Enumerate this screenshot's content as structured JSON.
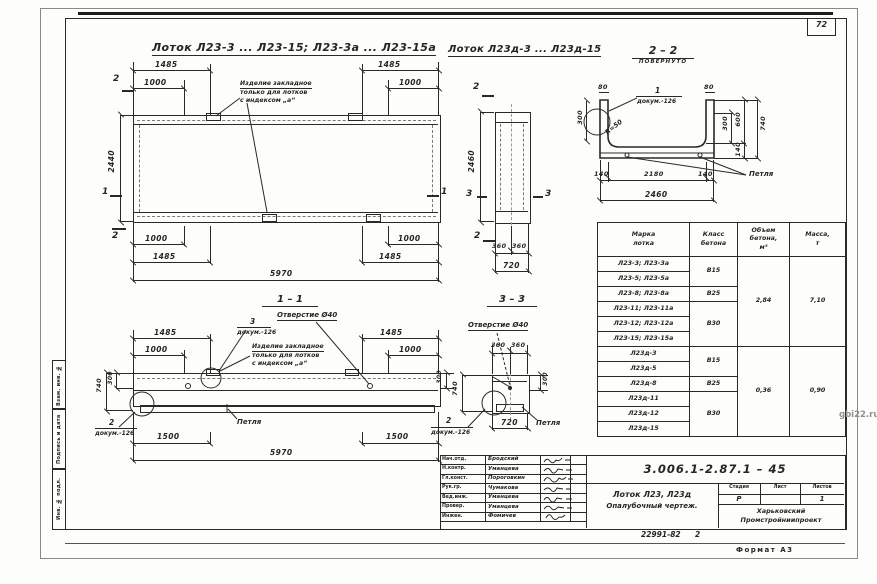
{
  "page": {
    "sheet_number": "72",
    "watermark": "gbi22.ru",
    "format_note": "Формат А3",
    "order_number": "22991-82",
    "order_extra": "2"
  },
  "margin_fields": {
    "f1": "Взам. инв. №",
    "f2": "Подпись и дата",
    "f3": "Инв. № подл."
  },
  "titles": {
    "view1": "Лоток Л23-3 ... Л23-15; Л23-3а ... Л23-15а",
    "view2": "Лоток Л23д-3 ... Л23д-15",
    "section22": "2 – 2",
    "section22_sub": "повернуто",
    "section11": "1 – 1",
    "section33": "3 – 3"
  },
  "notes": {
    "embed_line1": "Изделие закладное",
    "embed_line2": "только для лотков",
    "embed_line3": "с индексом „а“",
    "hole": "Отверстие Ø40",
    "loop": "Петля",
    "radius": "R=50",
    "doc_ref": "докум.-126",
    "c1": "1",
    "c2": "2",
    "c3": "3"
  },
  "markers": {
    "m1": "1",
    "m2": "2",
    "m3": "3"
  },
  "dims": {
    "d80": "80",
    "d140": "140",
    "d300": "300",
    "d360": "360",
    "d600": "600",
    "d720": "720",
    "d740": "740",
    "d1000": "1000",
    "d1485": "1485",
    "d1500": "1500",
    "d2180": "2180",
    "d2440": "2440",
    "d2460": "2460",
    "d5970": "5970"
  },
  "table": {
    "h_mark": "Марка\nлотка",
    "h_class": "Класс\nбетона",
    "h_volume": "Объем\nбетона,\nм³",
    "h_mass": "Масса,\nт",
    "marks": [
      "Л23-3; Л23-3а",
      "Л23-5; Л23-5а",
      "Л23-8; Л23-8а",
      "Л23-11; Л23-11а",
      "Л23-12; Л23-12а",
      "Л23-15; Л23-15а",
      "Л23д-3",
      "Л23д-5",
      "Л23д-8",
      "Л23д-11",
      "Л23д-12",
      "Л23д-15"
    ],
    "classes": [
      "В15",
      "В25",
      "В30",
      "В15",
      "В25",
      "В30"
    ],
    "volumes": [
      "2,84",
      "0,36"
    ],
    "masses": [
      "7,10",
      "0,90"
    ]
  },
  "titleblock": {
    "doc_number": "3.006.1-2.87.1 – 45",
    "title_line1": "Лоток Л23, Л23д",
    "title_line2": "Опалубочный чертеж.",
    "stage_label": "Стадия",
    "sheet_label": "Лист",
    "sheets_label": "Листов",
    "stage_value": "Р",
    "sheet_value": "",
    "sheets_value": "1",
    "org_line1": "Харьковский",
    "org_line2": "Промстройниипроект",
    "people": [
      {
        "role": "Нач.отд.",
        "name": "Бродский"
      },
      {
        "role": "Н.контр.",
        "name": "Уманцева"
      },
      {
        "role": "Гл.конст.",
        "name": "Пороговкин"
      },
      {
        "role": "Рук.гр.",
        "name": "Чумакова"
      },
      {
        "role": "Вед.инж.",
        "name": "Уманцева"
      },
      {
        "role": "Провер.",
        "name": "Уманцева"
      },
      {
        "role": "Инжен.",
        "name": "Фомичев"
      }
    ]
  }
}
